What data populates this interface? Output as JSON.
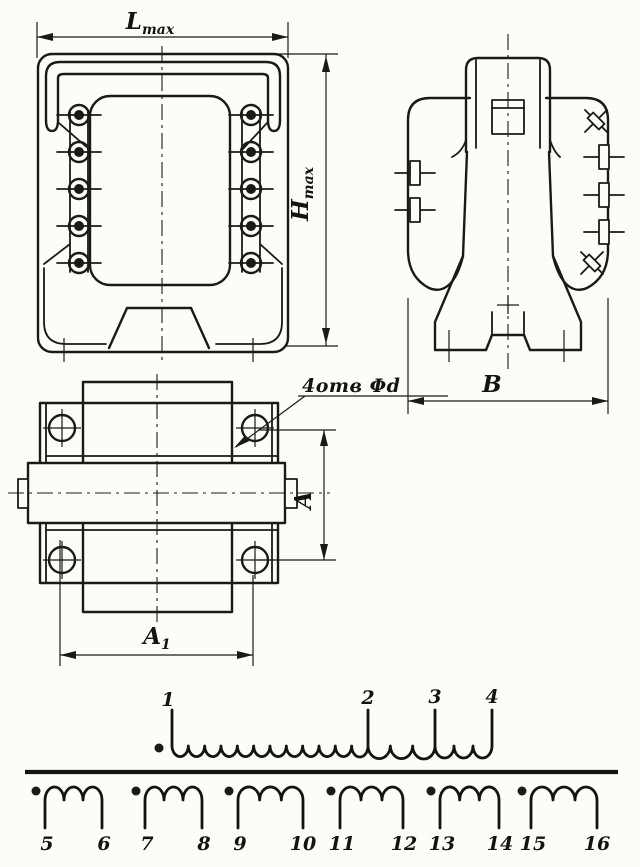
{
  "colors": {
    "ink": "#1b1a16",
    "paper": "#fcfcf9"
  },
  "dimension_labels": {
    "length": {
      "base": "L",
      "sub": "max"
    },
    "height": {
      "base": "H",
      "sub": "max"
    },
    "depth": {
      "base": "B",
      "sub": ""
    },
    "hole_pitch_vertical": {
      "base": "A",
      "sub": ""
    },
    "hole_pitch_horizontal": {
      "base": "A",
      "sub": "1"
    }
  },
  "callouts": {
    "mounting_holes": "4отв Φd"
  },
  "schematic": {
    "primary": {
      "terminals": [
        "1",
        "2",
        "3",
        "4"
      ],
      "polarity_dot": true,
      "sections": [
        {
          "from": "1",
          "to": "2",
          "turns_drawn": 12
        },
        {
          "from": "2",
          "to": "3",
          "turns_drawn": 3
        },
        {
          "from": "3",
          "to": "4",
          "turns_drawn": 3
        }
      ]
    },
    "secondaries": [
      {
        "start": "5",
        "end": "6",
        "turns_drawn": 3,
        "polarity_dot": true
      },
      {
        "start": "7",
        "end": "8",
        "turns_drawn": 3,
        "polarity_dot": true
      },
      {
        "start": "9",
        "end": "10",
        "turns_drawn": 3,
        "polarity_dot": true
      },
      {
        "start": "11",
        "end": "12",
        "turns_drawn": 3,
        "polarity_dot": true
      },
      {
        "start": "13",
        "end": "14",
        "turns_drawn": 3,
        "polarity_dot": true
      },
      {
        "start": "15",
        "end": "16",
        "turns_drawn": 3,
        "polarity_dot": true
      }
    ]
  }
}
